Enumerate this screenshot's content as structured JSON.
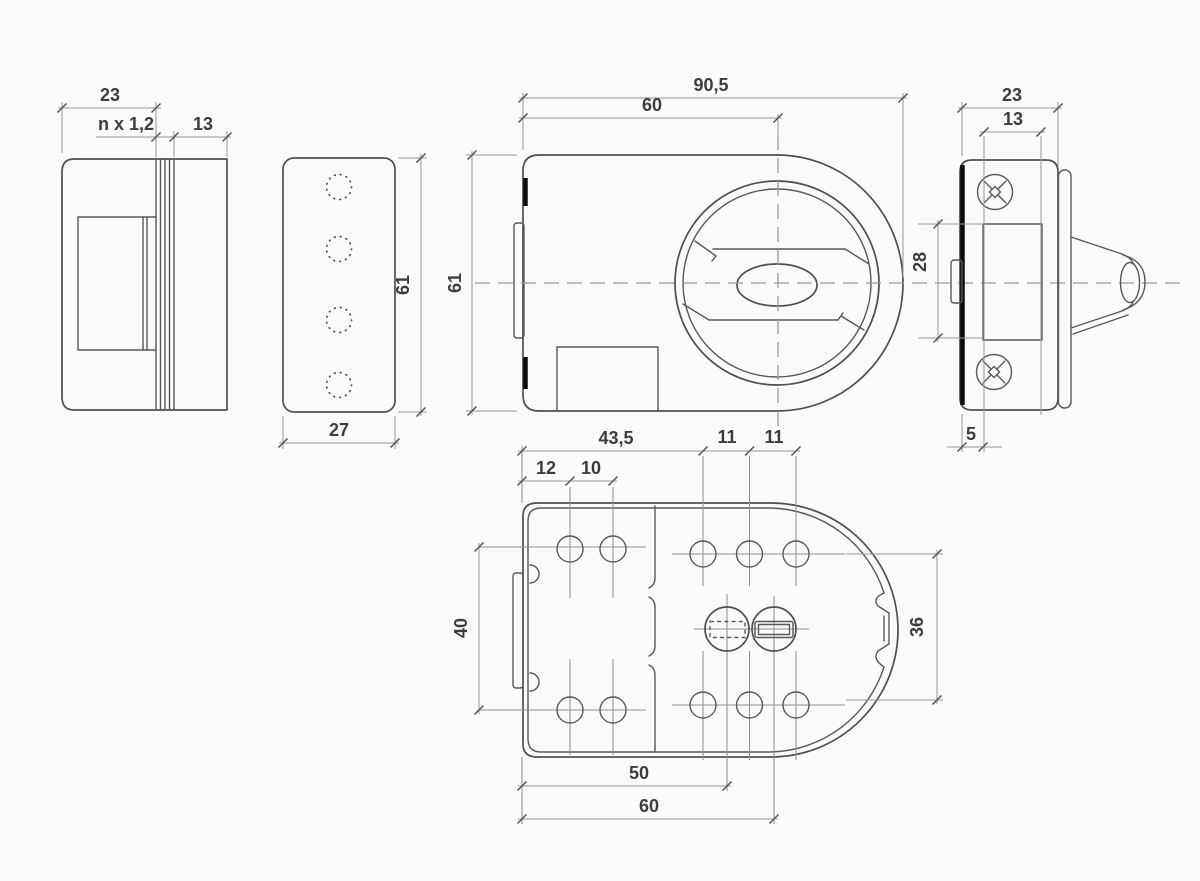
{
  "drawing": {
    "kind": "rim-lock technical drawing, 5 orthographic views",
    "colors": {
      "background": "#fafafa",
      "outline": "#4f4f4f",
      "dimension_lines": "#979797",
      "label_text": "#3d3d3d",
      "accent_black": "#0c0c0c"
    },
    "views": {
      "side_section": {
        "title": "left side view",
        "dims": {
          "depth": "23",
          "shim_stack": "n x 1,2",
          "rear_plate": "13"
        }
      },
      "strike_plate": {
        "title": "strike plate view",
        "dims": {
          "height": "61",
          "width": "27"
        }
      },
      "front": {
        "title": "front view",
        "dims": {
          "overall_width": "90,5",
          "knob_center_offset": "60",
          "height": "61"
        }
      },
      "right_side": {
        "title": "right side view",
        "dims": {
          "depth": "23",
          "latch_width": "13",
          "latch_height": "28",
          "plate_offset": "5"
        }
      },
      "rear": {
        "title": "rear / mounting plate view",
        "dims": {
          "hole_field": "43,5",
          "pitch_left_1": "12",
          "pitch_left_2": "10",
          "pitch_right_1": "11",
          "pitch_right_2": "11",
          "row_spacing": "40",
          "curve_height": "36",
          "spindle_center": "50",
          "knob_center": "60"
        }
      }
    }
  }
}
